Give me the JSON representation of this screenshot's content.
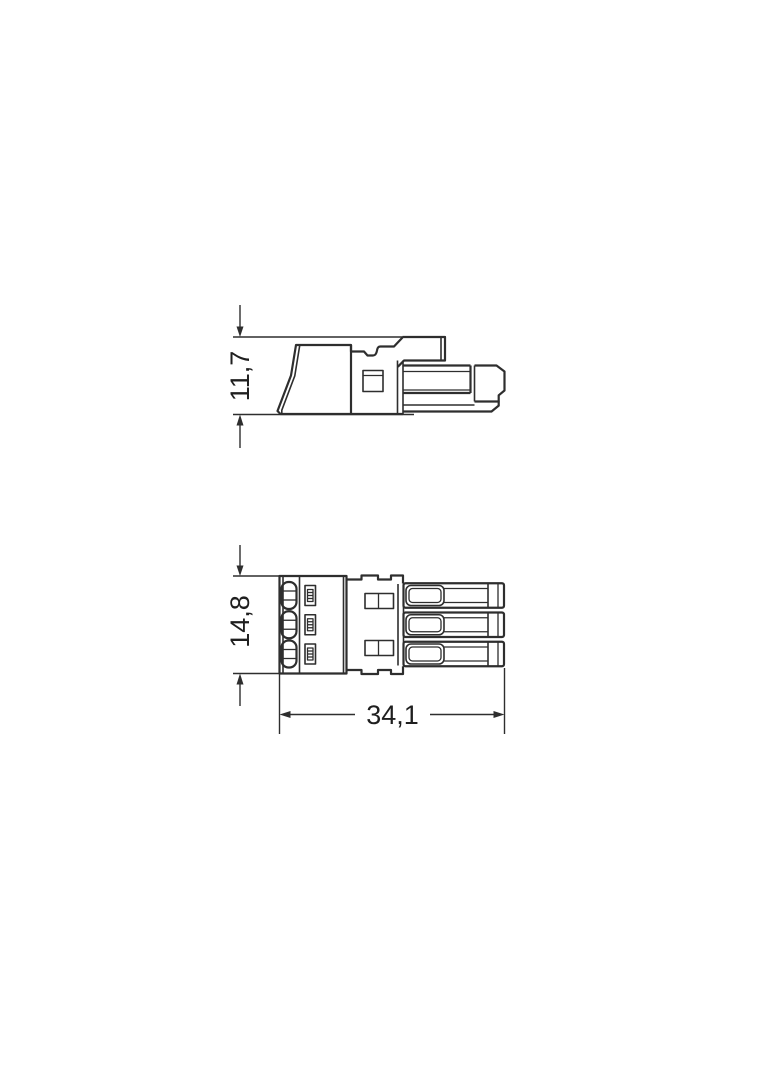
{
  "colors": {
    "background": "#ffffff",
    "line": "#2e2e2e",
    "text": "#1f1f1f"
  },
  "views": {
    "side_view": {
      "height_dimension": "11,7"
    },
    "front_view": {
      "height_dimension": "14,8",
      "length_dimension": "34,1"
    }
  }
}
